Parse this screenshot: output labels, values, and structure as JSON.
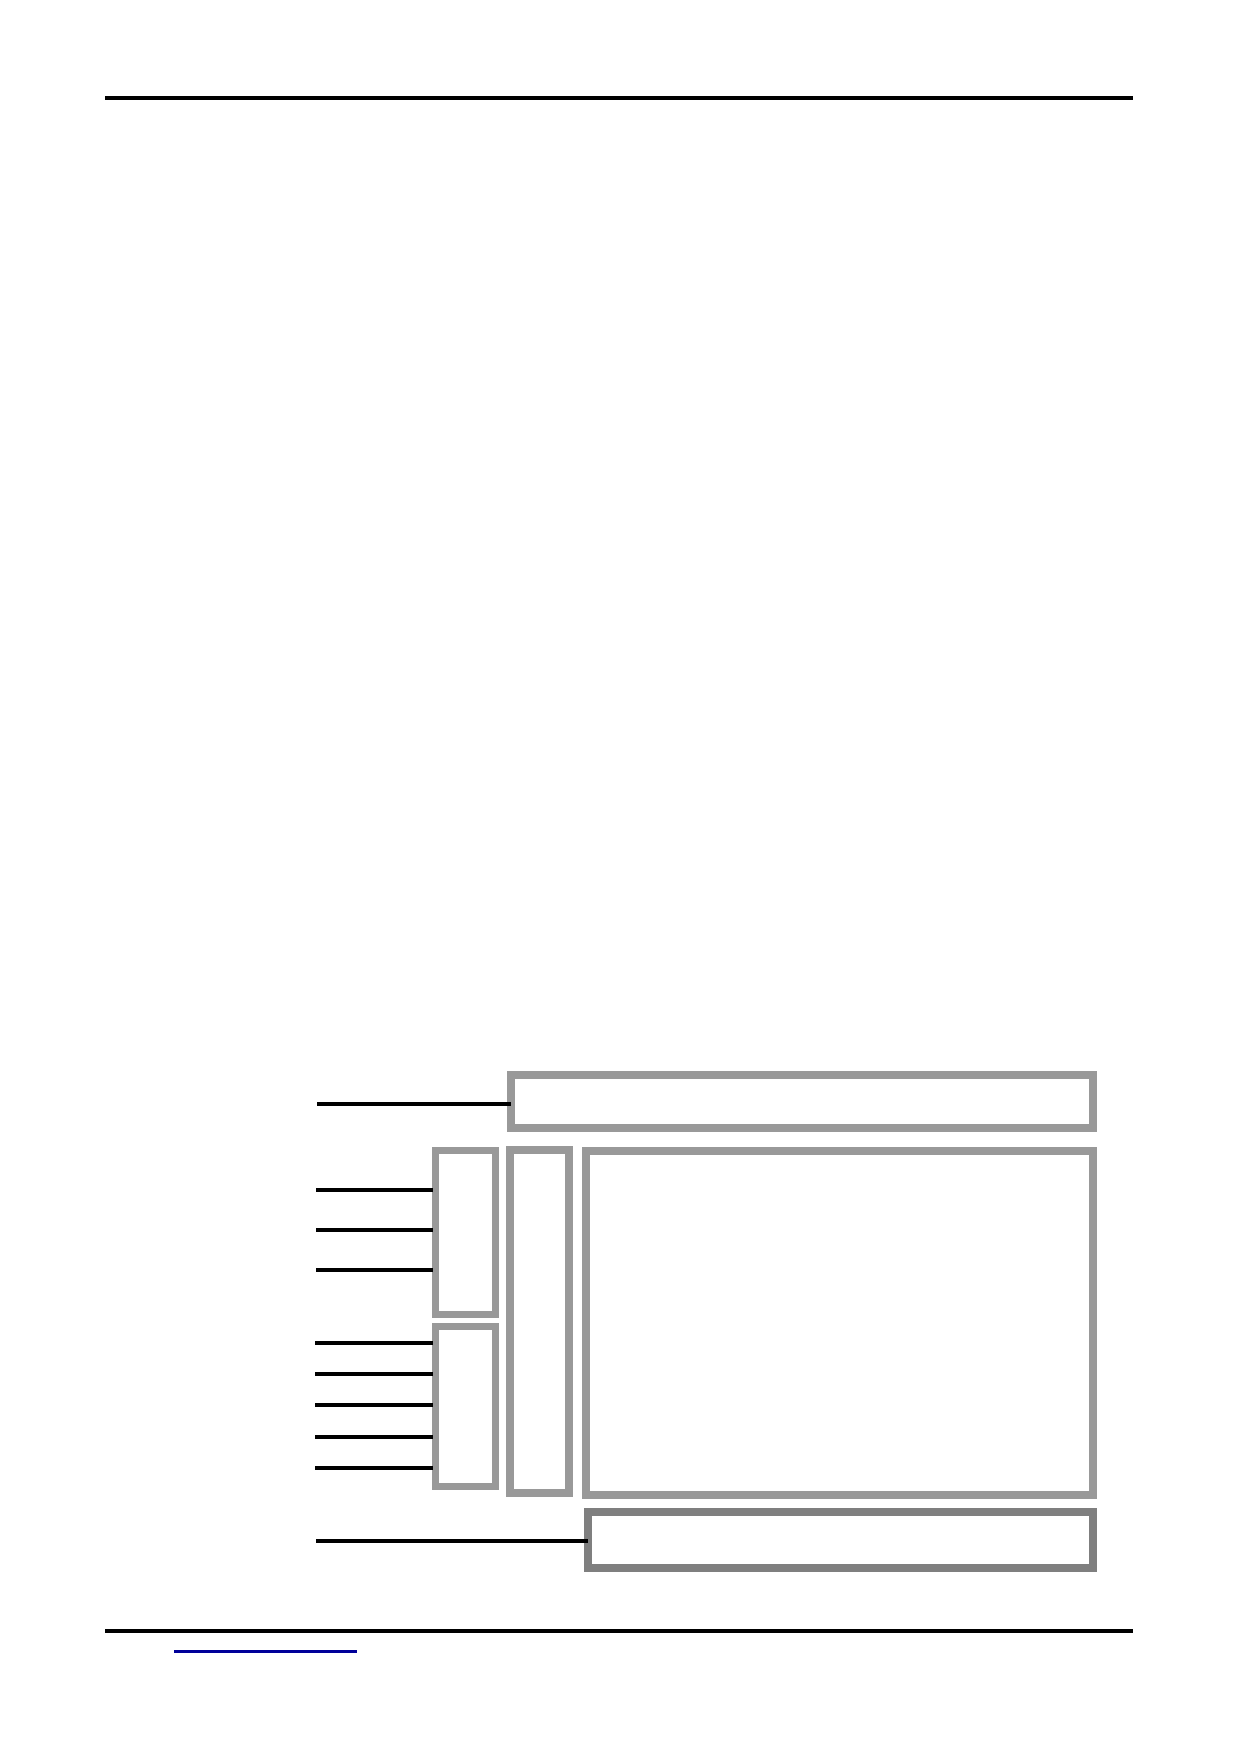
{
  "page": {
    "width_px": 1240,
    "height_px": 1754,
    "background": "#ffffff"
  },
  "colors": {
    "rule": "#000000",
    "callout": "#000000",
    "box_border": "#999999",
    "bottom_box_border": "#7f7f7f",
    "link": "#000099"
  },
  "header": {
    "rule": {
      "x": 105,
      "y": 96,
      "width": 1028,
      "height": 4
    }
  },
  "footer": {
    "rule": {
      "x": 105,
      "y": 1629,
      "width": 1028,
      "height": 4
    },
    "link": {
      "label": "",
      "underline": {
        "x": 174,
        "y": 1650,
        "width": 183,
        "height": 3
      }
    }
  },
  "figure": {
    "boxes": [
      {
        "name": "top-bar-box",
        "x": 507,
        "y": 1071,
        "w": 590,
        "h": 61,
        "border": 8,
        "color": "box_border"
      },
      {
        "name": "left-box-1",
        "x": 432,
        "y": 1147,
        "w": 67,
        "h": 171,
        "border": 7,
        "color": "box_border"
      },
      {
        "name": "left-box-2",
        "x": 432,
        "y": 1323,
        "w": 67,
        "h": 167,
        "border": 7,
        "color": "box_border"
      },
      {
        "name": "middle-column-box",
        "x": 506,
        "y": 1146,
        "w": 67,
        "h": 351,
        "border": 8,
        "color": "box_border"
      },
      {
        "name": "main-box",
        "x": 582,
        "y": 1147,
        "w": 515,
        "h": 352,
        "border": 8,
        "color": "box_border"
      },
      {
        "name": "bottom-bar-box",
        "x": 584,
        "y": 1508,
        "w": 513,
        "h": 64,
        "border": 8,
        "color": "bottom_box_border"
      }
    ],
    "callout_lines": [
      {
        "name": "callout-line-top-bar",
        "x1": 317,
        "x2": 511,
        "y": 1102,
        "h": 4
      },
      {
        "name": "callout-line-box1-1",
        "x1": 316,
        "x2": 433,
        "y": 1188,
        "h": 4
      },
      {
        "name": "callout-line-box1-2",
        "x1": 316,
        "x2": 433,
        "y": 1228,
        "h": 4
      },
      {
        "name": "callout-line-box1-3",
        "x1": 316,
        "x2": 433,
        "y": 1268,
        "h": 4
      },
      {
        "name": "callout-line-box2-1",
        "x1": 315,
        "x2": 433,
        "y": 1341,
        "h": 4
      },
      {
        "name": "callout-line-box2-2",
        "x1": 315,
        "x2": 433,
        "y": 1372,
        "h": 4
      },
      {
        "name": "callout-line-box2-3",
        "x1": 315,
        "x2": 433,
        "y": 1403,
        "h": 4
      },
      {
        "name": "callout-line-box2-4",
        "x1": 315,
        "x2": 433,
        "y": 1435,
        "h": 4
      },
      {
        "name": "callout-line-box2-5",
        "x1": 315,
        "x2": 433,
        "y": 1466,
        "h": 4
      },
      {
        "name": "callout-line-bottom-bar",
        "x1": 316,
        "x2": 588,
        "y": 1539,
        "h": 4
      }
    ]
  }
}
